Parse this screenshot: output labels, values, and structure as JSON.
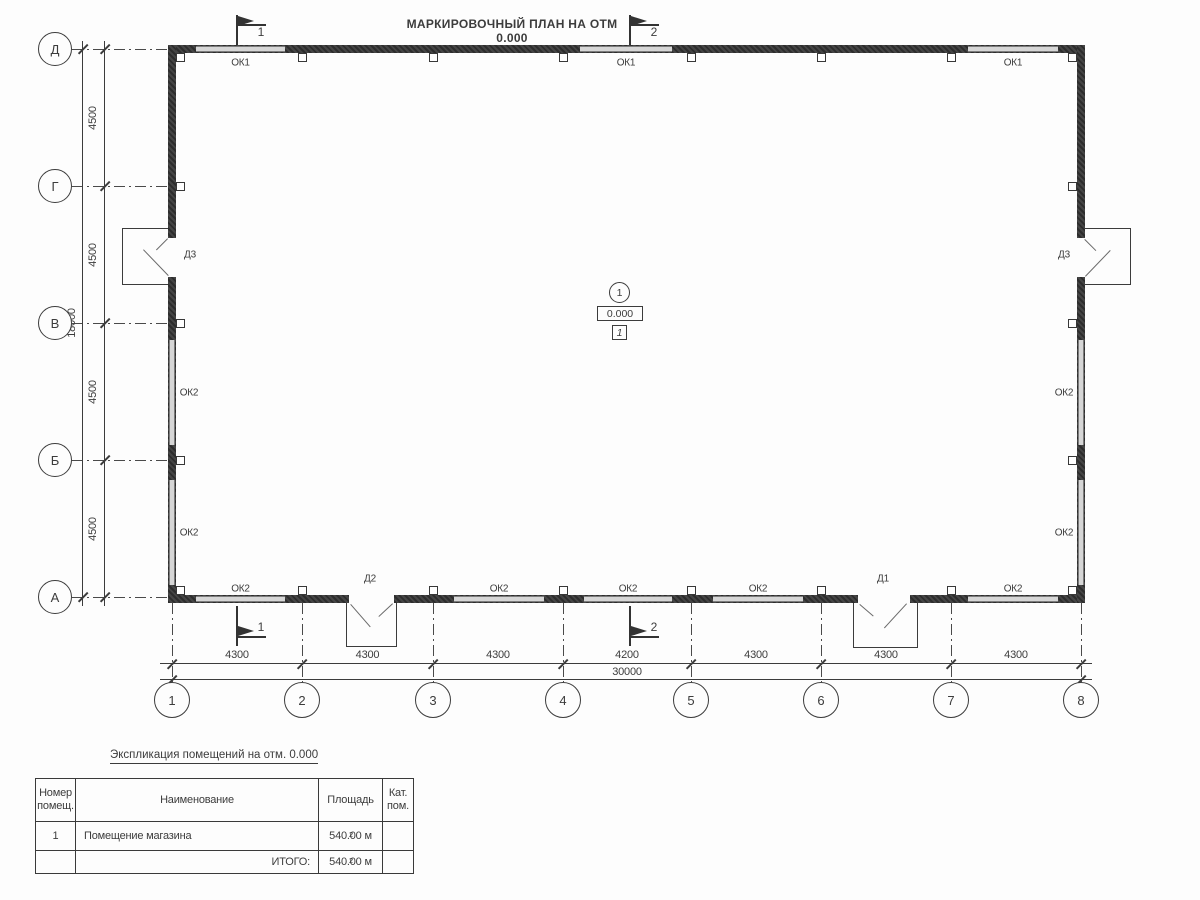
{
  "title": "МАРКИРОВОЧНЫЙ ПЛАН НА ОТМ 0.000",
  "colors": {
    "line": "#3c3c3c",
    "wall_dark": "#353535",
    "window_fill": "#d6d6d6",
    "background": "#fdfdfd"
  },
  "grid": {
    "row_axes": [
      "Д",
      "Г",
      "В",
      "Б",
      "А"
    ],
    "col_axes": [
      "1",
      "2",
      "3",
      "4",
      "5",
      "6",
      "7",
      "8"
    ]
  },
  "dims": {
    "col_segments": [
      "4300",
      "4300",
      "4300",
      "4200",
      "4300",
      "4300",
      "4300"
    ],
    "col_total": "30000",
    "row_segments": [
      "4500",
      "4500",
      "4500",
      "4500"
    ],
    "row_total": "18000"
  },
  "sections": {
    "s1": "1",
    "s2": "2"
  },
  "room_marker": {
    "number_circle": "1",
    "elevation": "0.000",
    "room_box": "1"
  },
  "labels": {
    "windows_top": [
      "ОК1",
      "ОК1",
      "ОК1"
    ],
    "windows_bottom": [
      "ОК2",
      "ОК2",
      "ОК2",
      "ОК2",
      "ОК2"
    ],
    "windows_left": [
      "ОК2",
      "ОК2"
    ],
    "windows_right": [
      "ОК2",
      "ОК2"
    ],
    "door_left": "Д3",
    "door_right": "Д3",
    "door_bottom_left": "Д2",
    "door_bottom_right": "Д1"
  },
  "schedule": {
    "heading": "Экспликация помещений на отм. 0.000",
    "columns": [
      "Номер помещ.",
      "Наименование",
      "Площадь",
      "Кат. пом."
    ],
    "rows": [
      {
        "num": "1",
        "name": "Помещение магазина",
        "area": "540.00 м",
        "area_sup": "2",
        "cat": ""
      },
      {
        "num": "",
        "name": "ИТОГО:",
        "area": "540.00 м",
        "area_sup": "2",
        "cat": ""
      }
    ]
  }
}
